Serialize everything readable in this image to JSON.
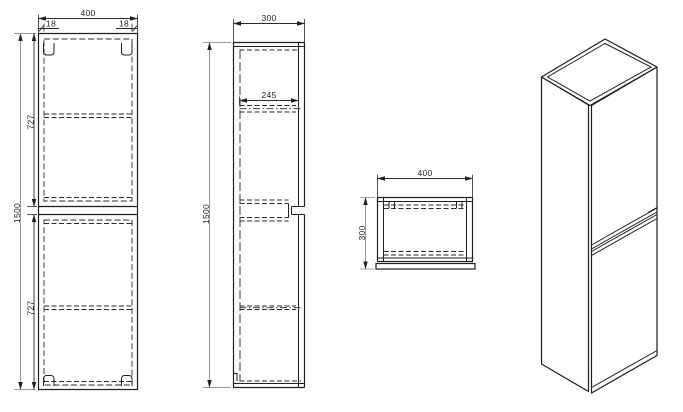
{
  "colors": {
    "outline": "#1f1f1f",
    "dimension_line": "#2a2a2a",
    "dimension_secondary": "#9a9a9a",
    "background": "#ffffff"
  },
  "front_view": {
    "width": "400",
    "left_edge": "18",
    "right_edge": "18",
    "height": "1500",
    "upper_section": "727",
    "lower_section": "727"
  },
  "side_view": {
    "depth": "300",
    "shelf_depth": "245",
    "height": "1500"
  },
  "top_view": {
    "width": "400",
    "depth": "300"
  }
}
